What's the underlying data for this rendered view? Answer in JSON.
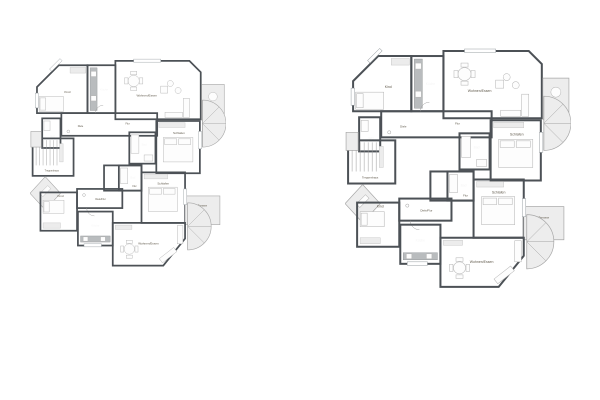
{
  "page": {
    "background_color": "#ffffff"
  },
  "floorplans": {
    "count": 2
  },
  "rooms": {
    "kind_top": "Kind",
    "kitchen_top": "Küche",
    "living_top": "Wohnen/Essen",
    "terrace_top": "Terrasse",
    "hall_diele_top": "Diele",
    "hall_flur_top": "Flur",
    "wc_top": "WC",
    "bath_top": "Bad",
    "bedroom_top": "Schlafen",
    "stairwell": "Treppenhaus",
    "bath_bottom": "Bad",
    "hall_flur_bottom": "Flur",
    "hall_diele_bottom": "Diele/Flur",
    "kind_bottom": "Kind",
    "kitchen_bottom": "Küche",
    "bedroom_bottom": "Schlafen",
    "living_bottom": "Wohnen/Essen",
    "terrace_bottom": "Terrasse"
  },
  "colors": {
    "wall": "#4c5156",
    "wood_floor": "#d3c7a9",
    "kitchen_tile": "#8f9396",
    "bath_tile": "#a2a7aa",
    "terrace": "#e3e3e3"
  }
}
